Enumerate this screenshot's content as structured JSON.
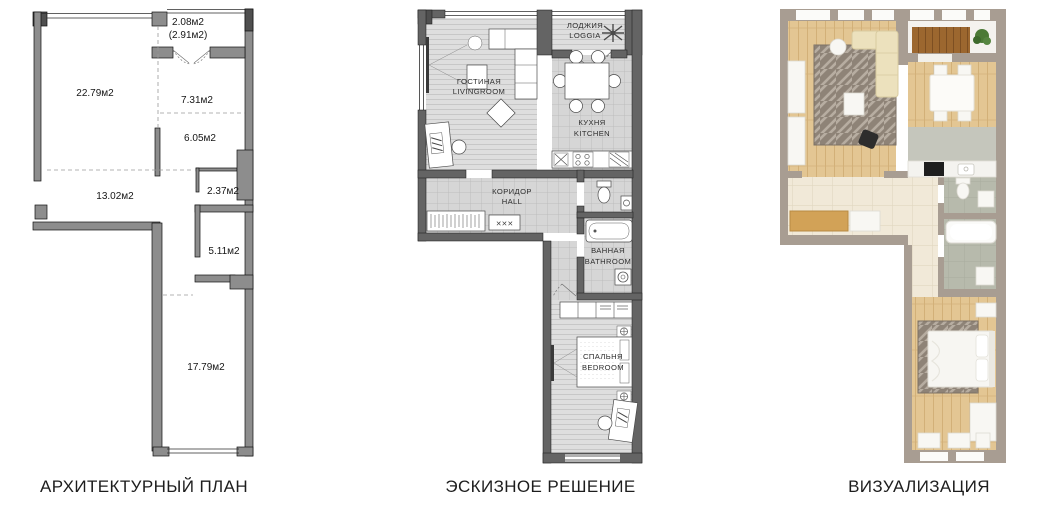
{
  "captions": {
    "architectural_plan": "АРХИТЕКТУРНЫЙ ПЛАН",
    "sketch": "ЭСКИЗНОЕ РЕШЕНИЕ",
    "visualization": "ВИЗУАЛИЗАЦИЯ"
  },
  "architectural_plan": {
    "areas": {
      "balcony": "2.08м2",
      "balcony_alt": "(2.91м2)",
      "living": "22.79м2",
      "kitchen": "7.31м2",
      "dining": "6.05м2",
      "hall": "13.02м2",
      "wc": "2.37м2",
      "bathroom": "5.11м2",
      "bedroom": "17.79м2"
    }
  },
  "sketch_plan": {
    "rooms": {
      "loggia": {
        "ru": "ЛОДЖИЯ",
        "en": "LOGGIA"
      },
      "living": {
        "ru": "ГОСТИНАЯ",
        "en": "LIVINGROOM"
      },
      "kitchen": {
        "ru": "КУХНЯ",
        "en": "KITCHEN"
      },
      "hall": {
        "ru": "КОРИДОР",
        "en": "HALL"
      },
      "bathroom": {
        "ru": "ВАННАЯ",
        "en": "BATHROOM"
      },
      "bedroom": {
        "ru": "СПАЛЬНЯ",
        "en": "BEDROOM"
      }
    },
    "shoe_rack_marks": "✕✕✕"
  },
  "colors": {
    "wall-plan": "#8d8d8d",
    "wall-sketch": "#646464",
    "wall-taupe": "#a89d92",
    "stripe-bg": "#dedede",
    "stripe-line": "#c7c7c7",
    "tile-bg": "#d6d6d6",
    "tile-line": "#bdbdbd",
    "wood": "#e3c693",
    "wood-line": "#d2b078",
    "deck": "#9c672f",
    "beige-tile": "#f1e9d8",
    "gray-tile": "#b7baac",
    "rug": "#8e8377",
    "rug-line": "#b7ada1",
    "sofa": "#ece1bd",
    "bench-wood": "#d2a257",
    "furn-white": "#f8f7f3",
    "plant": "#4c7a36",
    "ink": "#1d1d1d"
  }
}
